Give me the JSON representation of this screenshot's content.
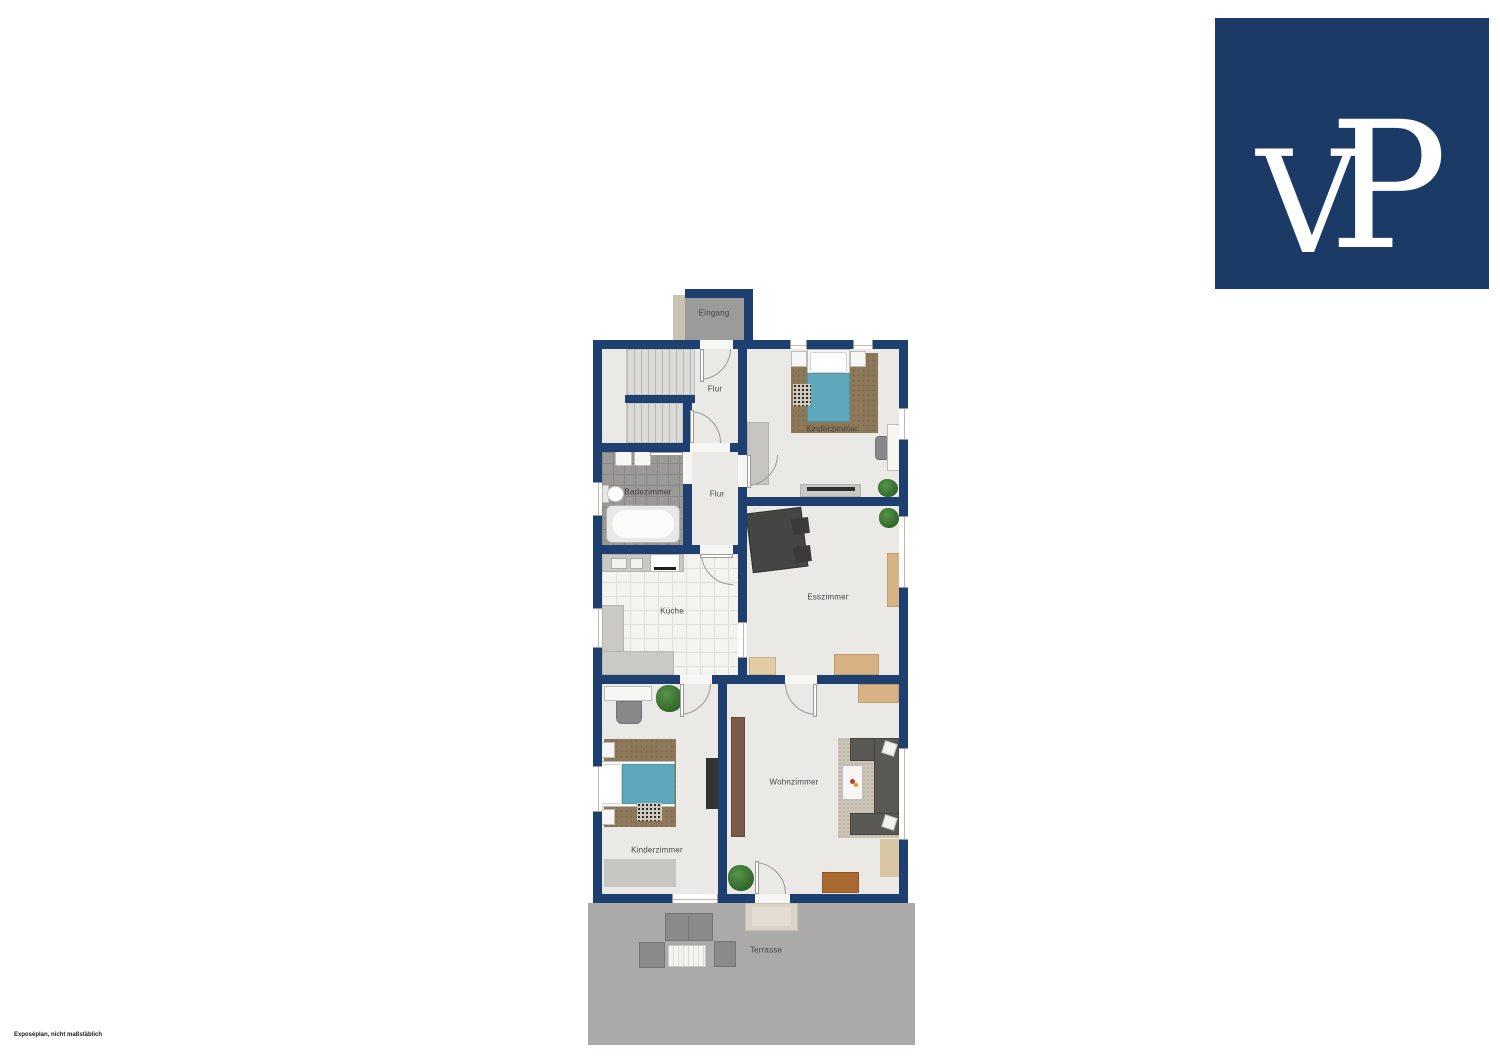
{
  "brand": {
    "logo_text": "VP",
    "logo_letters": {
      "first": "V",
      "second": "P"
    },
    "logo_bg": "#1c3a66",
    "logo_fg": "#ffffff"
  },
  "floorplan": {
    "wall_color": "#1e4070",
    "floor_color": "#eae9e5",
    "terrace_color": "#abaaa8",
    "accent_teal": "#5fa8bc",
    "rooms": [
      {
        "id": "eingang",
        "label": "Eingang"
      },
      {
        "id": "flur-upper",
        "label": "Flur"
      },
      {
        "id": "kinderzimmer-upper",
        "label": "Kinderzimmer"
      },
      {
        "id": "badezimmer",
        "label": "Badezimmer"
      },
      {
        "id": "flur-lower",
        "label": "Flur"
      },
      {
        "id": "kueche",
        "label": "Küche"
      },
      {
        "id": "esszimmer",
        "label": "Esszimmer"
      },
      {
        "id": "kinderzimmer-lower",
        "label": "Kinderzimmer"
      },
      {
        "id": "wohnzimmer",
        "label": "Wohnzimmer"
      },
      {
        "id": "terrasse",
        "label": "Terrasse"
      }
    ]
  },
  "footer": {
    "disclaimer": "Exposéplan, nicht maßstäblich"
  }
}
